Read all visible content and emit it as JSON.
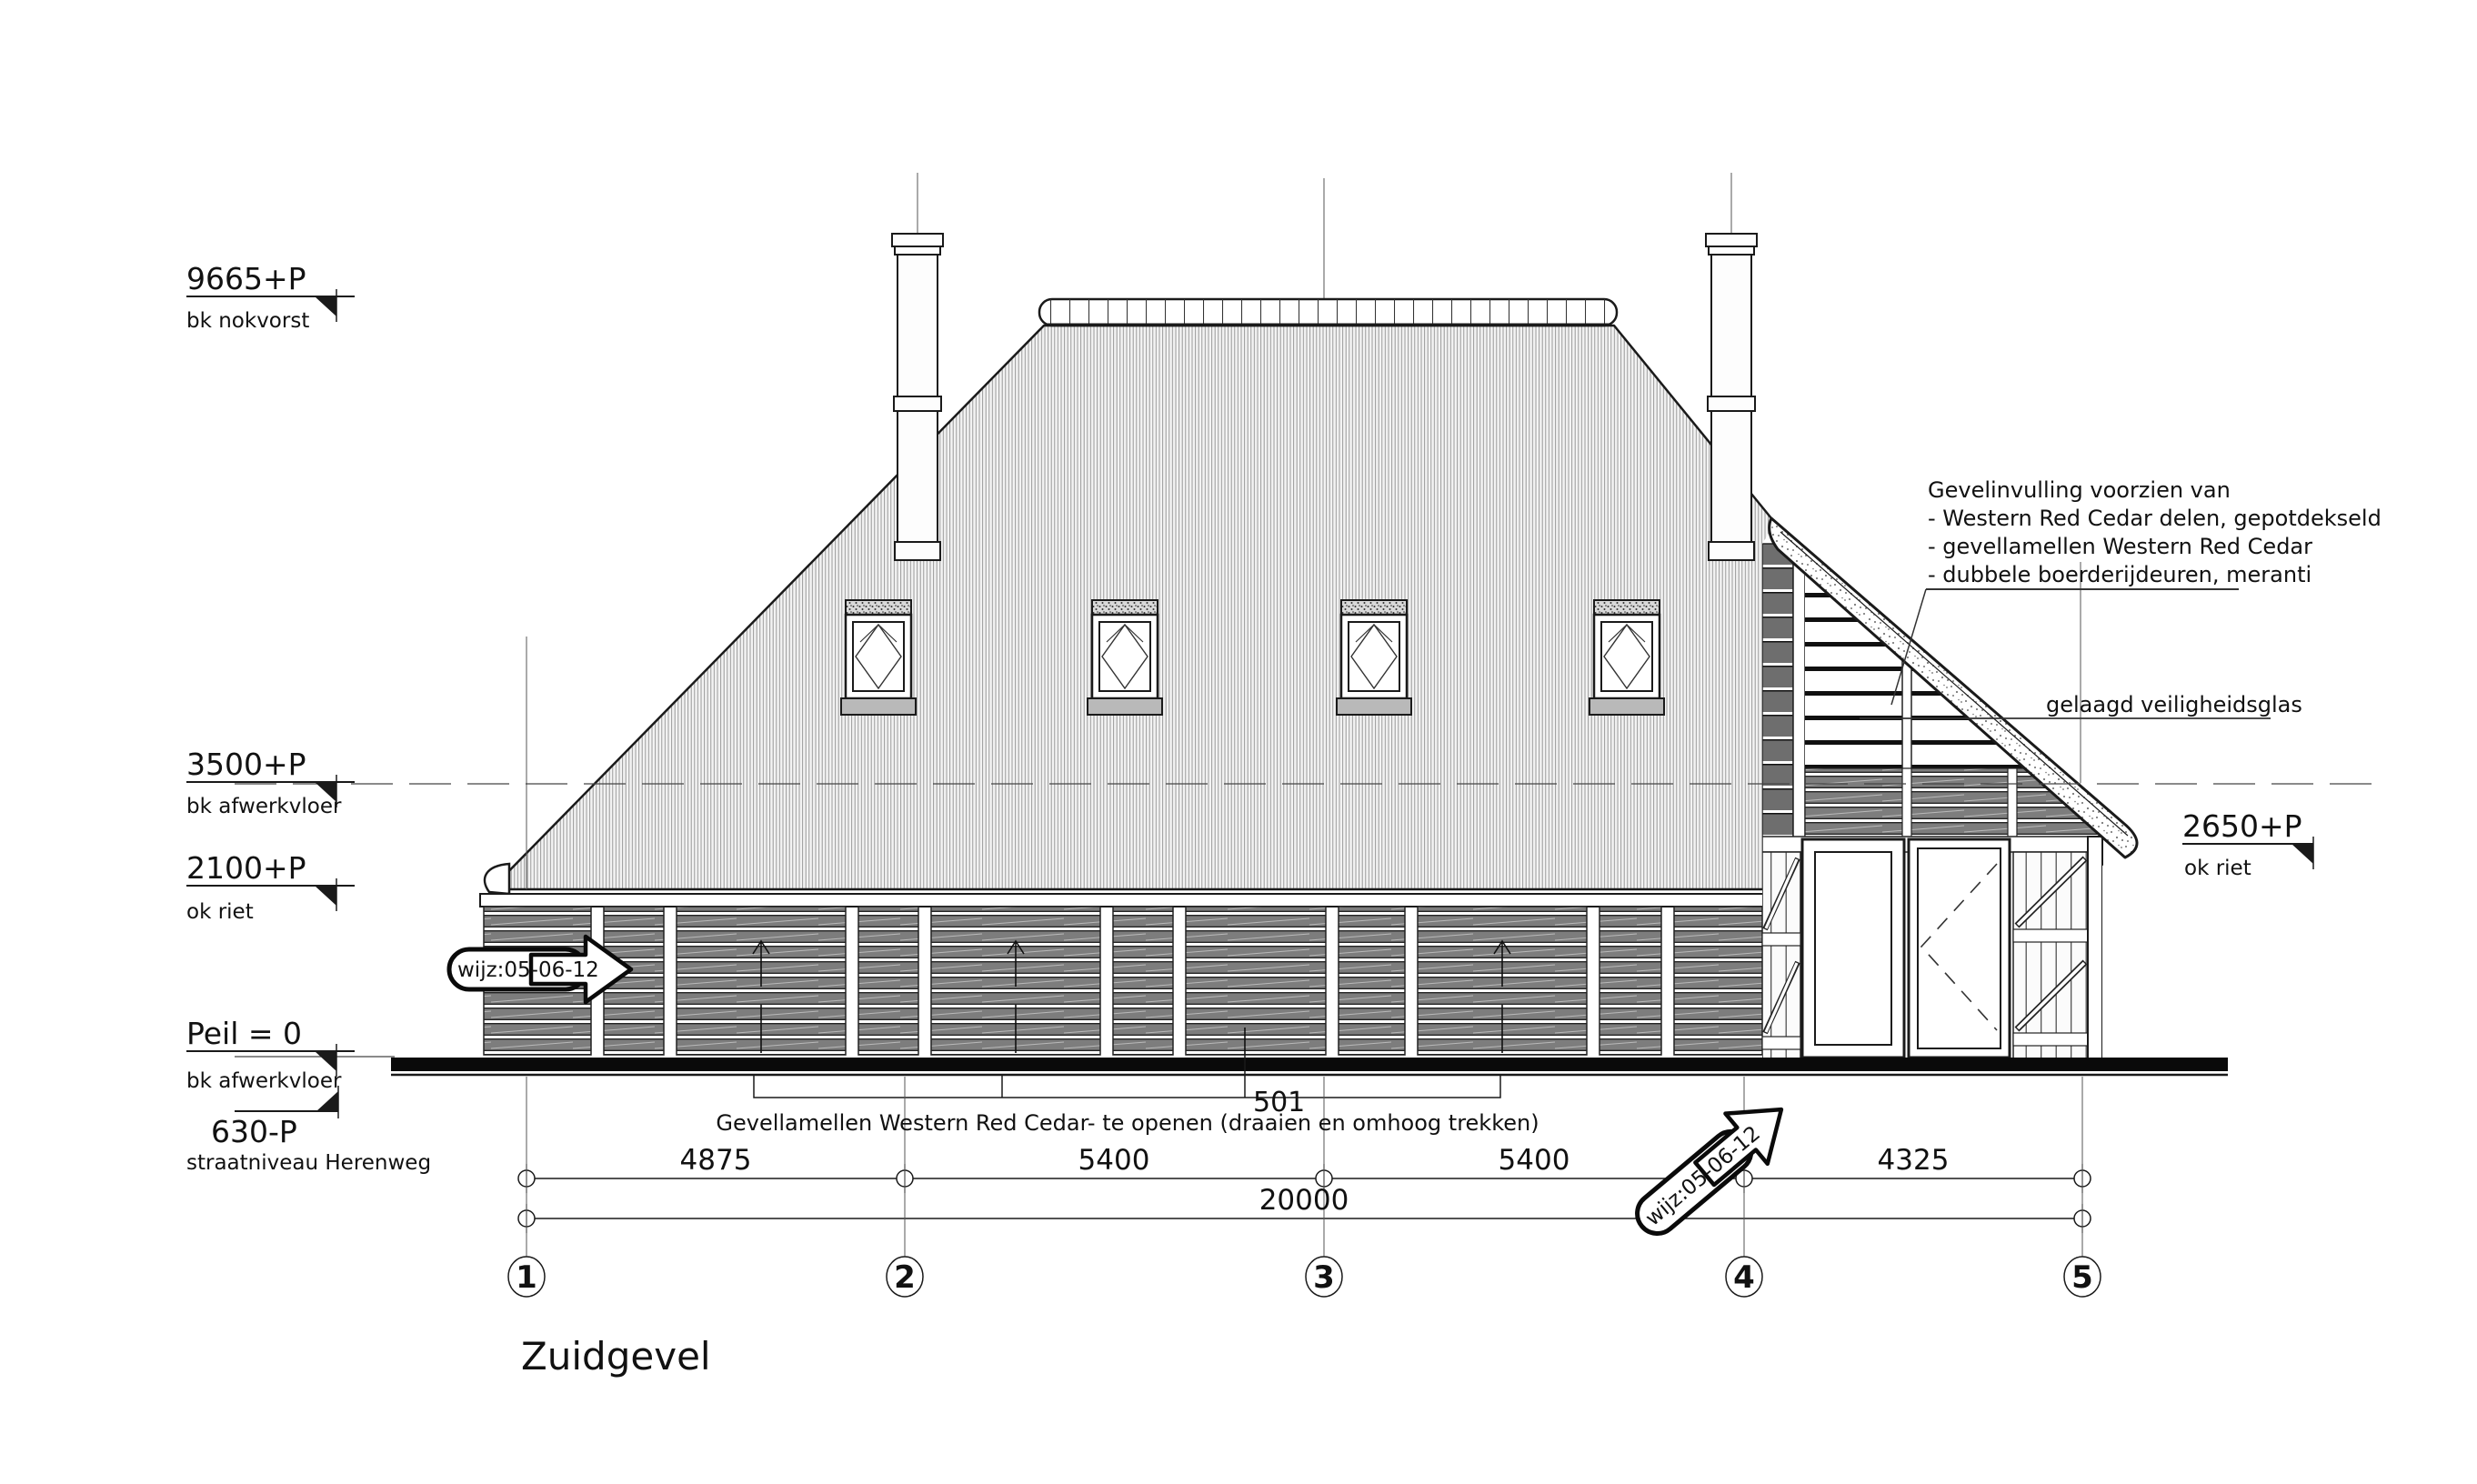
{
  "drawing": {
    "title": "Zuidgevel",
    "revision_stamp": "wijz:05-06-12",
    "levels": {
      "nok": {
        "value": "9665+P",
        "label": "bk nokvorst"
      },
      "floor_up": {
        "value": "3500+P",
        "label": "bk afwerkvloer"
      },
      "riet_left": {
        "value": "2100+P",
        "label": "ok riet"
      },
      "peil": {
        "value": "Peil = 0",
        "label": "bk afwerkvloer"
      },
      "street": {
        "value": "630-P",
        "label": "straatniveau Herenweg"
      },
      "riet_right": {
        "value": "2650+P",
        "label": "ok riet"
      }
    },
    "notes": {
      "gevelinvulling": {
        "line1": "Gevelinvulling voorzien van",
        "line2": "- Western Red Cedar delen, gepotdekseld",
        "line3": "- gevellamellen Western Red Cedar",
        "line4": "- dubbele boerderijdeuren, meranti"
      },
      "glass": "gelaagd veiligheidsglas",
      "lamellen_ref": "501",
      "lamellen_caption": "Gevellamellen Western Red Cedar- te openen  (draaien en omhoog trekken)"
    },
    "dimensions": {
      "span_1_2": "4875",
      "span_2_3": "5400",
      "span_3_4": "5400",
      "span_4_5": "4325",
      "total": "20000"
    },
    "grid": {
      "b1": "1",
      "b2": "2",
      "b3": "3",
      "b4": "4",
      "b5": "5"
    }
  }
}
